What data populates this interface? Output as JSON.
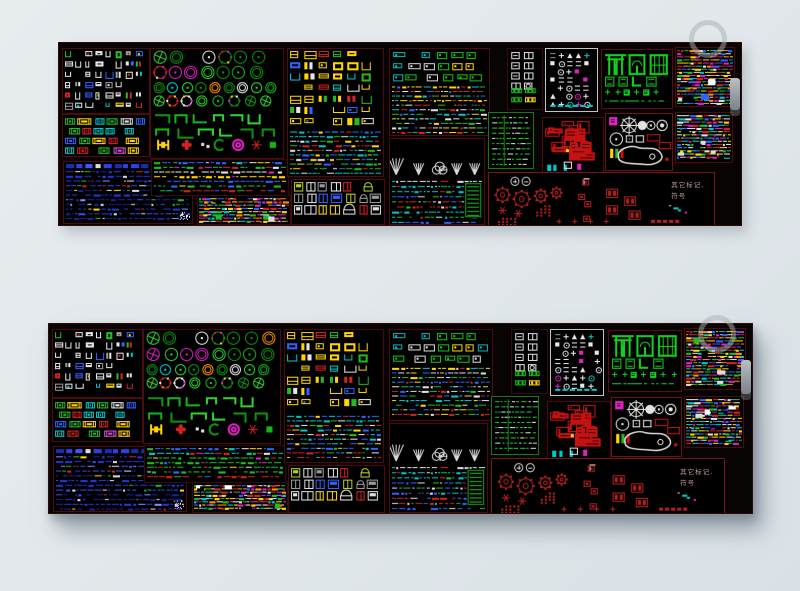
{
  "page": {
    "description": "Two preview thumbnails of the same AutoCAD block-library sheet (dense colorful CAD symbols on black) on a pale blue-grey background",
    "background": "#e1e7ea",
    "panel_background": "#080404",
    "section_border_default": "#4a0c0c"
  },
  "labels": {
    "other_marks_line1": "其它标记,",
    "other_marks_line2": "符号"
  },
  "panels": [
    {
      "id": "top",
      "left": 58,
      "top": 42,
      "width": 682,
      "height": 182
    },
    {
      "id": "bottom",
      "left": 48,
      "top": 323,
      "width": 703,
      "height": 189
    }
  ],
  "scrollbar": {
    "top_pct": 19,
    "height_pct": 18,
    "color": "#9aa2a8"
  },
  "watermark_rings": [
    {
      "cx": 708,
      "cy": 39,
      "r": 19
    },
    {
      "cx": 717,
      "cy": 334,
      "r": 19
    }
  ],
  "sections": [
    {
      "name": "furniture-blocks",
      "style": "furn",
      "x": 0.4,
      "y": 2.6,
      "w": 12.7,
      "h": 35.4,
      "seed": 11,
      "border": "#4a0c0c",
      "palette": [
        "#e6e6e6",
        "#ffd400",
        "#d42222",
        "#00c8c8",
        "#2f62ff",
        "#28b828",
        "#9a9a9a"
      ]
    },
    {
      "name": "car-blocks",
      "style": "cars",
      "x": 0.4,
      "y": 39.2,
      "w": 12.7,
      "h": 22.2,
      "seed": 22,
      "border": "#4a0c0c",
      "palette": [
        "#00c8c8",
        "#24b824",
        "#d42222",
        "#ffd400",
        "#2f62ff",
        "#e0e0e0",
        "#d44fd4"
      ]
    },
    {
      "name": "blue-text-list",
      "style": "bluetext",
      "x": 0.6,
      "y": 64.6,
      "w": 18.8,
      "h": 33.9,
      "seed": 33,
      "border": "#4a0c0c",
      "palette": [
        "#2436d6",
        "#3a4cf0",
        "#16249c",
        "#dcdcdc",
        "#7e8eff",
        "#d42222",
        "#24b824",
        "#ffd400"
      ]
    },
    {
      "name": "plant-blocks",
      "style": "plants",
      "x": 13.4,
      "y": 2.6,
      "w": 19.3,
      "h": 59.8,
      "seed": 44,
      "border": "#4a0c0c",
      "palette": [
        "#17b317",
        "#0e9210",
        "#2fd32f"
      ]
    },
    {
      "name": "multicolor-text-rows",
      "style": "rowsmix",
      "x": 13.5,
      "y": 64.0,
      "w": 20.0,
      "h": 19.0,
      "seed": 55,
      "border": "#3a0a0a",
      "palette": [
        "#24b824",
        "#e0e0e0",
        "#d42222",
        "#2f62ff",
        "#ffd400",
        "#00c8c8",
        "#e020c0"
      ]
    },
    {
      "name": "dense-mix-left",
      "style": "densemix",
      "x": 20.3,
      "y": 83.6,
      "w": 13.4,
      "h": 15.3,
      "seed": 66,
      "border": "#3a0a0a",
      "palette": [
        "#24b824",
        "#d42222",
        "#2f62ff",
        "#e0e0e0",
        "#ffd400",
        "#00c8c8",
        "#e020c0",
        "#ff8c00"
      ]
    },
    {
      "name": "bed-sofa-blocks",
      "style": "beds",
      "x": 33.4,
      "y": 2.6,
      "w": 13.9,
      "h": 69.8,
      "seed": 77,
      "border": "#4a0c0c",
      "palette": [
        "#ffd400",
        "#2f62ff",
        "#d42222",
        "#e6e6e6",
        "#00c8c8",
        "#24b824"
      ]
    },
    {
      "name": "door-elevations",
      "style": "doors",
      "x": 34.0,
      "y": 74.6,
      "w": 13.5,
      "h": 24.3,
      "seed": 88,
      "border": "#4a0c0c",
      "palette": [
        "#e0e0e0",
        "#b8cc22",
        "#ffd400",
        "#2f62ff",
        "#d42222",
        "#9a9a9a"
      ]
    },
    {
      "name": "machine-blocks-text",
      "style": "machines",
      "x": 48.4,
      "y": 2.6,
      "w": 14.5,
      "h": 47.6,
      "seed": 99,
      "border": "#4a0c0c",
      "palette": [
        "#d42222",
        "#24b824",
        "#2f62ff",
        "#e0e0e0",
        "#ffd400",
        "#00c8c8"
      ]
    },
    {
      "name": "tree-blocks",
      "style": "trees",
      "x": 48.4,
      "y": 52.4,
      "w": 13.8,
      "h": 46.6,
      "seed": 111,
      "border": "#4a0c0c",
      "palette": [
        "#2f62ff",
        "#dcdcdc",
        "#24b824",
        "#d42222",
        "#00c8c8"
      ]
    },
    {
      "name": "appliance-blocks",
      "style": "appl",
      "x": 65.7,
      "y": 2.6,
      "w": 5.0,
      "h": 33.3,
      "seed": 122,
      "border": "#3a0a0a",
      "palette": [
        "#dcdcdc",
        "#18c018",
        "#ffd400"
      ]
    },
    {
      "name": "symbol-arrows",
      "style": "symbols",
      "x": 71.3,
      "y": 2.6,
      "w": 7.4,
      "h": 34.4,
      "seed": 133,
      "border": "#c0c4c8",
      "palette": [
        "#e8e8e8",
        "#e020c0",
        "#ffd400",
        "#00c8c8",
        "#909090"
      ]
    },
    {
      "name": "green-gate-elevations",
      "style": "gates",
      "x": 79.5,
      "y": 3.2,
      "w": 10.2,
      "h": 31.7,
      "seed": 144,
      "border": "#5a0d0d",
      "palette": [
        "#0fd01f"
      ]
    },
    {
      "name": "dense-mix-topright",
      "style": "densemix",
      "x": 90.3,
      "y": 2.1,
      "w": 8.5,
      "h": 31.7,
      "seed": 155,
      "border": "#4a0c0c",
      "palette": [
        "#24b824",
        "#d42222",
        "#2f62ff",
        "#e0e0e0",
        "#ffd400",
        "#00c8c8",
        "#e020c0",
        "#ff8c00"
      ]
    },
    {
      "name": "green-schedule-table",
      "style": "greentable",
      "x": 62.9,
      "y": 38.1,
      "w": 6.5,
      "h": 30.2,
      "seed": 166,
      "border": "#157a15",
      "palette": [
        "#1ec81e",
        "#dcdcdc"
      ]
    },
    {
      "name": "red-furniture-blocks",
      "style": "redblocks",
      "x": 70.8,
      "y": 40.7,
      "w": 8.8,
      "h": 30.2,
      "seed": 177,
      "border": "#4a0c0c",
      "palette": [
        "#c41212",
        "#00c8c8",
        "#e020c0",
        "#e6e6e6",
        "#ffd400"
      ]
    },
    {
      "name": "pool-compass-blocks",
      "style": "pool",
      "x": 80.0,
      "y": 38.6,
      "w": 9.7,
      "h": 30.7,
      "seed": 188,
      "border": "#6b1212",
      "palette": [
        "#e2e2e2",
        "#c41212",
        "#e020c0",
        "#ffd400",
        "#24b824"
      ]
    },
    {
      "name": "dense-mix-right",
      "style": "densemix",
      "x": 90.3,
      "y": 38.1,
      "w": 8.3,
      "h": 26.5,
      "seed": 199,
      "border": "#4a0c0c",
      "palette": [
        "#24b824",
        "#d42222",
        "#2f62ff",
        "#e0e0e0",
        "#ffd400",
        "#00c8c8",
        "#e020c0"
      ]
    },
    {
      "name": "other-marks-symbols",
      "style": "sparsered",
      "x": 62.9,
      "y": 70.9,
      "w": 33.0,
      "h": 28.6,
      "seed": 210,
      "border": "#7a1515",
      "palette": [
        "#b02020",
        "#d0d0d0",
        "#00c8c8",
        "#e020c0",
        "#24b824"
      ],
      "label": true
    }
  ]
}
